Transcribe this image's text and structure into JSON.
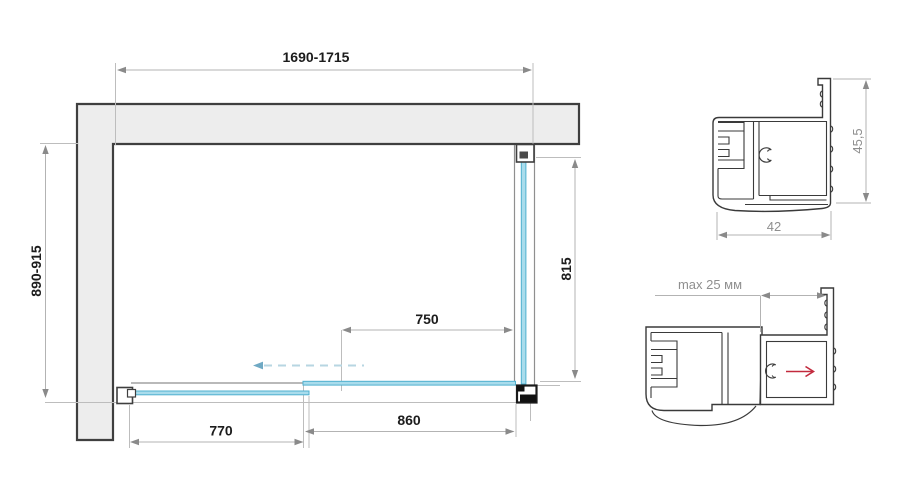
{
  "drawing": {
    "title": "shower-enclosure-installation-diagram",
    "plan_view": {
      "width_range": "1690-1715",
      "depth_range": "890-915",
      "side_glass_height": "815",
      "door_opening": "750",
      "rear_fixed_glass": "770",
      "door_glass": "860"
    },
    "profile_top": {
      "height": "45,5",
      "width": "42"
    },
    "profile_bottom": {
      "adjustment": "max 25 мм"
    },
    "colors": {
      "glass_fill": "#a9dcec",
      "glass_edge": "#4fb0cf",
      "wall_fill": "#ededed",
      "outline": "#3a3a3a",
      "dimension": "#8a8a8a",
      "red_arrow": "#c22a3d",
      "slide_arrow": "#6fa9c4"
    }
  }
}
